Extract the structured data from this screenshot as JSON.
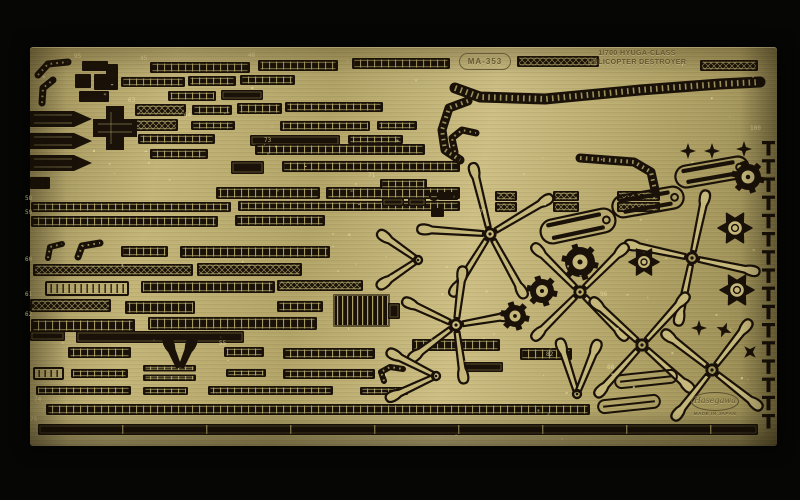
{
  "photo": {
    "badge": "MA-353",
    "title_line1": "1/700 HYUGA-CLASS",
    "title_line2": "HELICOPTER DESTROYER",
    "logo_maker": "Hasegawa",
    "logo_origin": "MADE IN JAPAN",
    "colors": {
      "bg": "#060605",
      "brass": "#b7a96c",
      "blade": "#c6b87b",
      "etch": "#1a1208",
      "tick": "#b4a76b",
      "speck": "#efe3a8",
      "text": "#655831"
    },
    "etch": {
      "strips": [
        [
          150,
          62,
          100,
          11,
          "r"
        ],
        [
          258,
          60,
          80,
          11,
          "r"
        ],
        [
          352,
          58,
          98,
          11,
          "r"
        ],
        [
          517,
          56,
          82,
          11,
          "m"
        ],
        [
          700,
          60,
          58,
          11,
          "m"
        ],
        [
          121,
          77,
          64,
          10,
          "r"
        ],
        [
          188,
          76,
          48,
          10,
          "r"
        ],
        [
          240,
          75,
          55,
          10,
          "r"
        ],
        [
          168,
          91,
          48,
          10,
          "r"
        ],
        [
          221,
          90,
          42,
          10,
          "s"
        ],
        [
          135,
          104,
          51,
          12,
          "m"
        ],
        [
          192,
          105,
          40,
          10,
          "r"
        ],
        [
          237,
          103,
          45,
          11,
          "r"
        ],
        [
          285,
          102,
          98,
          10,
          "r"
        ],
        [
          128,
          119,
          50,
          12,
          "m"
        ],
        [
          191,
          121,
          44,
          9,
          "r"
        ],
        [
          280,
          121,
          90,
          10,
          "r"
        ],
        [
          377,
          121,
          40,
          9,
          "r"
        ],
        [
          138,
          134,
          77,
          10,
          "r"
        ],
        [
          250,
          135,
          90,
          11,
          "s"
        ],
        [
          348,
          135,
          55,
          9,
          "r"
        ],
        [
          150,
          149,
          58,
          10,
          "r"
        ],
        [
          255,
          144,
          170,
          11,
          "r"
        ],
        [
          231,
          161,
          33,
          13,
          "s"
        ],
        [
          282,
          161,
          178,
          11,
          "r"
        ],
        [
          216,
          187,
          104,
          12,
          "r"
        ],
        [
          326,
          187,
          134,
          12,
          "r"
        ],
        [
          31,
          202,
          200,
          10,
          "r"
        ],
        [
          238,
          201,
          222,
          10,
          "r"
        ],
        [
          31,
          216,
          187,
          11,
          "r"
        ],
        [
          235,
          215,
          90,
          11,
          "r"
        ],
        [
          380,
          179,
          47,
          10,
          "r"
        ],
        [
          121,
          246,
          47,
          11,
          "r"
        ],
        [
          180,
          246,
          150,
          12,
          "r"
        ],
        [
          33,
          264,
          160,
          12,
          "m"
        ],
        [
          197,
          263,
          105,
          13,
          "m"
        ],
        [
          46,
          282,
          82,
          13,
          "o"
        ],
        [
          141,
          281,
          134,
          12,
          "r"
        ],
        [
          277,
          280,
          86,
          11,
          "m"
        ],
        [
          30,
          299,
          81,
          13,
          "m"
        ],
        [
          125,
          301,
          70,
          13,
          "r"
        ],
        [
          277,
          301,
          46,
          11,
          "r"
        ],
        [
          333,
          294,
          57,
          33,
          "g"
        ],
        [
          388,
          303,
          12,
          16,
          "s"
        ],
        [
          31,
          319,
          104,
          13,
          "r"
        ],
        [
          148,
          317,
          169,
          13,
          "r"
        ],
        [
          30,
          331,
          35,
          10,
          "s"
        ],
        [
          76,
          331,
          168,
          12,
          "s"
        ],
        [
          68,
          347,
          63,
          11,
          "r"
        ],
        [
          224,
          347,
          40,
          10,
          "r"
        ],
        [
          283,
          348,
          92,
          11,
          "r"
        ],
        [
          412,
          339,
          88,
          12,
          "r"
        ],
        [
          520,
          348,
          52,
          12,
          "r"
        ],
        [
          34,
          368,
          29,
          11,
          "o"
        ],
        [
          71,
          369,
          57,
          9,
          "r"
        ],
        [
          143,
          365,
          53,
          16,
          "d"
        ],
        [
          226,
          369,
          40,
          8,
          "r"
        ],
        [
          283,
          369,
          92,
          10,
          "r"
        ],
        [
          458,
          362,
          45,
          10,
          "s"
        ],
        [
          36,
          386,
          95,
          9,
          "r"
        ],
        [
          143,
          387,
          45,
          8,
          "r"
        ],
        [
          208,
          386,
          125,
          9,
          "r"
        ],
        [
          360,
          387,
          48,
          8,
          "r"
        ],
        [
          46,
          404,
          544,
          11,
          "r"
        ],
        [
          38,
          424,
          720,
          11,
          "q"
        ],
        [
          495,
          191,
          22,
          10,
          "m"
        ],
        [
          495,
          202,
          22,
          10,
          "m"
        ],
        [
          553,
          191,
          26,
          10,
          "m"
        ],
        [
          553,
          202,
          26,
          10,
          "m"
        ],
        [
          617,
          191,
          43,
          10,
          "m"
        ],
        [
          617,
          202,
          43,
          10,
          "m"
        ],
        [
          382,
          198,
          22,
          8,
          "s"
        ],
        [
          408,
          198,
          18,
          8,
          "s"
        ]
      ],
      "bands": [
        {
          "p": [
            [
              38,
              75
            ],
            [
              48,
              64
            ],
            [
              68,
              62
            ]
          ],
          "w": 7
        },
        {
          "p": [
            [
              42,
              103
            ],
            [
              43,
              88
            ],
            [
              53,
              80
            ]
          ],
          "w": 7
        },
        {
          "p": [
            [
              48,
              258
            ],
            [
              50,
              247
            ],
            [
              62,
              244
            ]
          ],
          "w": 6
        },
        {
          "p": [
            [
              78,
              257
            ],
            [
              82,
              246
            ],
            [
              100,
              243
            ]
          ],
          "w": 7
        },
        {
          "p": [
            [
              455,
              88
            ],
            [
              480,
              97
            ],
            [
              545,
              99
            ],
            [
              640,
              90
            ],
            [
              720,
              84
            ],
            [
              760,
              82
            ]
          ],
          "w": 11
        },
        {
          "p": [
            [
              468,
              101
            ],
            [
              449,
              108
            ],
            [
              442,
              130
            ],
            [
              445,
              150
            ],
            [
              460,
              160
            ]
          ],
          "w": 9
        },
        {
          "p": [
            [
              580,
              158
            ],
            [
              634,
              162
            ],
            [
              651,
              172
            ],
            [
              655,
              190
            ]
          ],
          "w": 9
        },
        {
          "p": [
            [
              455,
              152
            ],
            [
              452,
              138
            ],
            [
              462,
              130
            ],
            [
              476,
              133
            ]
          ],
          "w": 7
        },
        {
          "p": [
            [
              384,
              381
            ],
            [
              381,
              372
            ],
            [
              390,
              367
            ],
            [
              403,
              369
            ]
          ],
          "w": 6
        }
      ],
      "rotors": [
        {
          "cx": 490,
          "cy": 234,
          "len": 66,
          "a": [
            256,
            184,
            122,
            61,
            329
          ]
        },
        {
          "cx": 456,
          "cy": 325,
          "len": 52,
          "a": [
            277,
            205,
            143,
            82,
            350
          ]
        },
        {
          "cx": 692,
          "cy": 258,
          "len": 62,
          "a": [
            12,
            102,
            192,
            282
          ]
        },
        {
          "cx": 580,
          "cy": 292,
          "len": 60,
          "a": [
            45,
            135,
            225,
            315
          ]
        },
        {
          "cx": 642,
          "cy": 345,
          "len": 62,
          "a": [
            42,
            132,
            222,
            312
          ]
        },
        {
          "cx": 712,
          "cy": 370,
          "len": 56,
          "a": [
            38,
            128,
            218,
            308
          ]
        }
      ],
      "vees": [
        {
          "x": 418,
          "y": 260,
          "a": [
            215,
            146
          ],
          "len": 46,
          "solid": false
        },
        {
          "x": 436,
          "y": 376,
          "a": [
            207,
            155
          ],
          "len": 52,
          "solid": false
        },
        {
          "x": 180,
          "y": 370,
          "a": [
            247,
            293
          ],
          "len": 33,
          "solid": true
        },
        {
          "x": 577,
          "y": 394,
          "a": [
            252,
            292
          ],
          "len": 55,
          "solid": false
        }
      ],
      "bundles": [
        {
          "cx": 712,
          "cy": 172,
          "l": 74,
          "h": 22,
          "r": -10
        },
        {
          "cx": 648,
          "cy": 202,
          "l": 72,
          "h": 22,
          "r": -10
        },
        {
          "cx": 578,
          "cy": 226,
          "l": 76,
          "h": 24,
          "r": -12
        }
      ],
      "capsules": [
        {
          "cx": 646,
          "cy": 379,
          "l": 62,
          "h": 13,
          "r": -6
        },
        {
          "cx": 629,
          "cy": 404,
          "l": 62,
          "h": 13,
          "r": -6
        }
      ],
      "gears": [
        [
          580,
          262,
          15
        ],
        [
          542,
          291,
          12
        ],
        [
          515,
          316,
          11
        ],
        [
          748,
          177,
          13
        ]
      ],
      "stars": [
        [
          735,
          228,
          17
        ],
        [
          644,
          262,
          15
        ],
        [
          737,
          290,
          17
        ]
      ],
      "crosses": [
        [
          688,
          151,
          8,
          0
        ],
        [
          712,
          151,
          8,
          0
        ],
        [
          744,
          149,
          8,
          0
        ],
        [
          699,
          328,
          8,
          0
        ],
        [
          724,
          330,
          8,
          22
        ],
        [
          750,
          352,
          8,
          45
        ]
      ],
      "comb": {
        "x": 762,
        "y0": 141,
        "dy": 18.2,
        "n": 16
      },
      "wedges": [
        [
          30,
          111
        ],
        [
          30,
          133
        ],
        [
          30,
          155
        ]
      ],
      "smallrects": [
        [
          30,
          177,
          20,
          12
        ],
        [
          82,
          61,
          26,
          10
        ],
        [
          75,
          74,
          16,
          14
        ],
        [
          94,
          74,
          24,
          16
        ],
        [
          79,
          91,
          30,
          11
        ],
        [
          106,
          64,
          12,
          16
        ],
        [
          431,
          208,
          13,
          9
        ],
        [
          438,
          192,
          20,
          8
        ]
      ],
      "circles": [
        [
          434,
          196,
          4
        ]
      ],
      "plus": {
        "pts": "106,106 124,106 124,119 137,119 137,137 124,137 124,150 106,150 106,137 93,137 93,119 106,119"
      },
      "labels": [
        {
          "t": "45",
          "x": 140,
          "y": 60
        },
        {
          "t": "46",
          "x": 248,
          "y": 57
        },
        {
          "t": "95",
          "x": 74,
          "y": 58
        },
        {
          "t": "63",
          "x": 128,
          "y": 102
        },
        {
          "t": "64",
          "x": 184,
          "y": 117
        },
        {
          "t": "73",
          "x": 264,
          "y": 142
        },
        {
          "t": "58",
          "x": 25,
          "y": 200
        },
        {
          "t": "59",
          "x": 25,
          "y": 214
        },
        {
          "t": "60",
          "x": 25,
          "y": 261
        },
        {
          "t": "61",
          "x": 25,
          "y": 296
        },
        {
          "t": "62",
          "x": 25,
          "y": 316
        },
        {
          "t": "55",
          "x": 219,
          "y": 345
        },
        {
          "t": "74",
          "x": 34,
          "y": 401
        },
        {
          "t": "75",
          "x": 30,
          "y": 421
        },
        {
          "t": "77",
          "x": 479,
          "y": 214
        },
        {
          "t": "82",
          "x": 546,
          "y": 356
        },
        {
          "t": "96",
          "x": 600,
          "y": 296
        },
        {
          "t": "100",
          "x": 750,
          "y": 130
        },
        {
          "t": "88",
          "x": 607,
          "y": 369
        },
        {
          "t": "71",
          "x": 368,
          "y": 177
        }
      ]
    }
  }
}
